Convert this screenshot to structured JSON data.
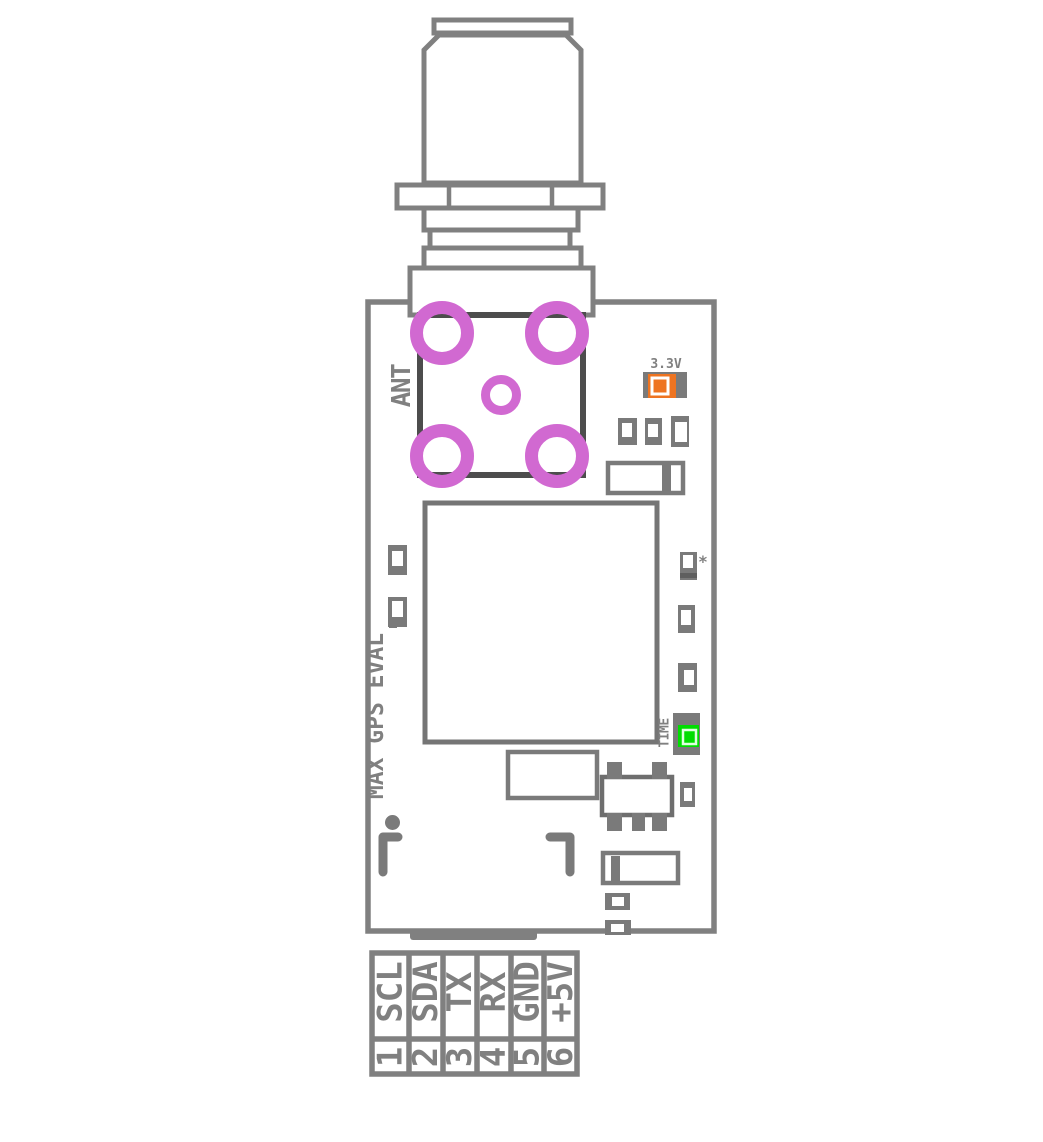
{
  "diagram": {
    "title": "MAX GPS EVAL",
    "antenna_label": "ANT",
    "power_led_label": "3.3V",
    "time_led_label": "TIME",
    "component_mark": "*",
    "connector": {
      "pins": [
        {
          "number": "1",
          "label": "SCL"
        },
        {
          "number": "2",
          "label": "SDA"
        },
        {
          "number": "3",
          "label": "TX"
        },
        {
          "number": "4",
          "label": "RX"
        },
        {
          "number": "5",
          "label": "GND"
        },
        {
          "number": "6",
          "label": "+5V"
        }
      ]
    },
    "colors": {
      "outline_gray": "#808080",
      "component_gray": "#7a7a7a",
      "dark_gray": "#4d4d4d",
      "pad_magenta": "#d169d1",
      "led_orange": "#ee7421",
      "led_green": "#00dd00"
    }
  }
}
